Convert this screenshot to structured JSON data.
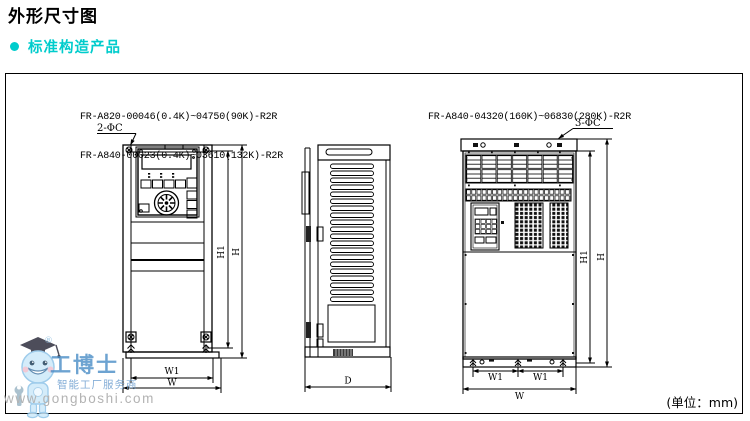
{
  "page": {
    "title": "外形尺寸图",
    "section": "标准构造产品",
    "unit_note": "(单位：mm)"
  },
  "models": {
    "small_frame_line1": "FR-A820-00046(0.4K)~04750(90K)-R2R",
    "small_frame_line2": "FR-A840-00023(0.4K)~03610(132K)-R2R",
    "large_frame_line1": "FR-A840-04320(160K)~06830(280K)-R2R"
  },
  "dims": {
    "holes_small": "2-ΦC",
    "holes_large": "3-ΦC",
    "width_inner": "W1",
    "width_outer": "W",
    "height_inner": "H1",
    "height_outer": "H",
    "depth": "D"
  },
  "watermark": {
    "registered": "®",
    "brand": "工博士",
    "tagline": "智能工厂服务商",
    "url": "www.gongboshi.com"
  },
  "colors": {
    "accent": "#00cccc",
    "line": "#000000",
    "watermark_blue": "#488cc6",
    "watermark_gray": "#b3b3b3"
  }
}
